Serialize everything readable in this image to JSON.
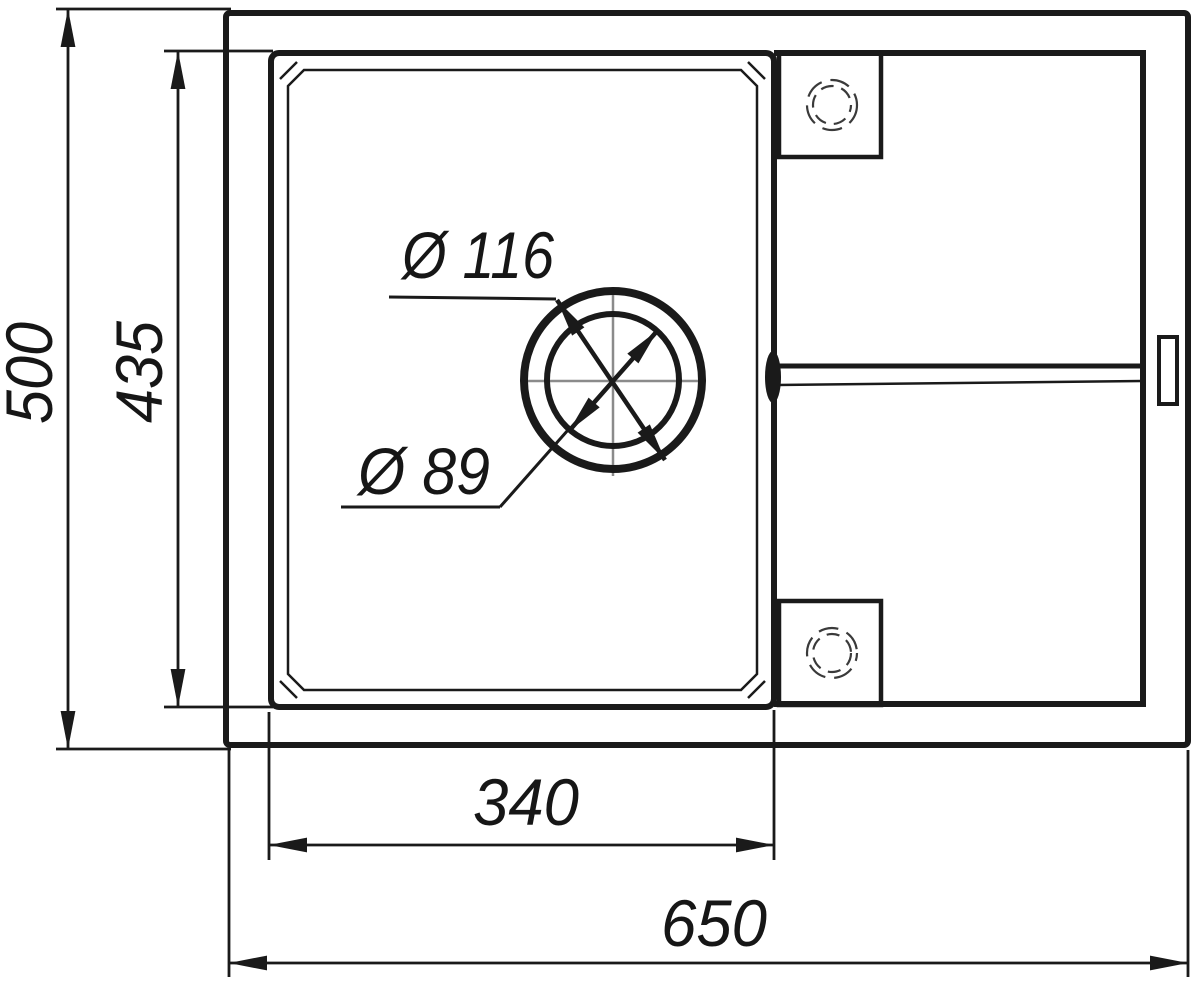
{
  "drawing": {
    "kind": "technical-drawing",
    "subject": "kitchen-sink-top-view",
    "labels": {
      "overall_width": "650",
      "overall_depth": "500",
      "bowl_width": "340",
      "bowl_depth": "435",
      "drain_flange_diameter": "Ø 116",
      "drain_hole_diameter": "Ø 89"
    },
    "colors": {
      "line": "#1a1a1a",
      "centerline": "#8b8b8b",
      "hole_dash": "#3a3a3a",
      "background": "#ffffff"
    }
  }
}
